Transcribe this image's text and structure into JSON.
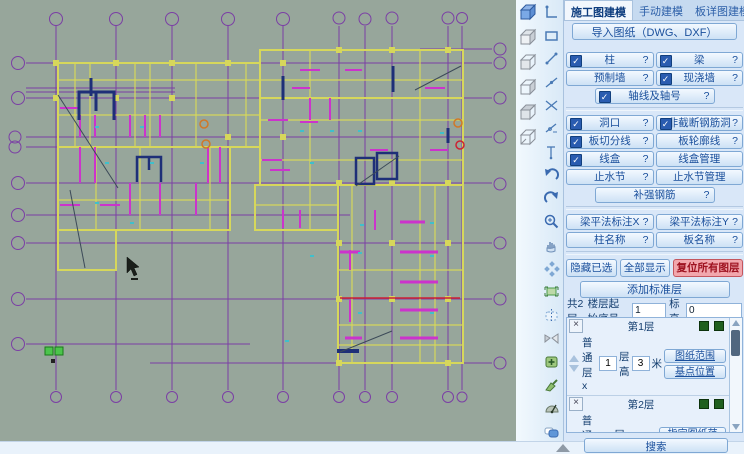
{
  "header": {
    "tab1": "施工图建模",
    "tab2": "手动建模",
    "tab3": "板详图建模",
    "import_label": "导入图纸（DWG、DXF）"
  },
  "glyphs": {
    "check": "✓",
    "help": "?",
    "close": "×"
  },
  "panel": {
    "toggles": {
      "zhu": {
        "label": "柱"
      },
      "liang": {
        "label": "梁"
      },
      "yzq": {
        "label": "预制墙"
      },
      "xjq": {
        "label": "现浇墙"
      },
      "zhou": {
        "label": "轴线及轴号"
      },
      "dong": {
        "label": "洞口"
      },
      "fjd": {
        "label": "非截断钢筋洞"
      },
      "bqfx": {
        "label": "板切分线"
      },
      "blkx": {
        "label": "板轮廓线"
      },
      "xh": {
        "label": "线盒"
      },
      "xhgl": {
        "label": "线盒管理"
      },
      "zsj": {
        "label": "止水节"
      },
      "zsjgl": {
        "label": "止水节管理"
      },
      "bqgj": {
        "label": "补强钢筋"
      },
      "lpfx": {
        "label": "梁平法标注X"
      },
      "lpfy": {
        "label": "梁平法标注Y"
      },
      "zmc": {
        "label": "柱名称"
      },
      "bmc": {
        "label": "板名称"
      }
    },
    "actions": {
      "hide_selected": "隐藏已选",
      "show_all": "全部显示",
      "reset_layers": "复位所有图层"
    },
    "add_standard_layer": "添加标准层",
    "summary": {
      "total": "共2层",
      "start_label": "楼层起始序号",
      "start_value": "1",
      "elev_label": "标高",
      "elev_value": "0"
    },
    "layers": {
      "items": [
        {
          "name": "第1层",
          "type_prefix": "普通层x",
          "count": "1",
          "height_label": "层高",
          "height": "3",
          "unit": "米",
          "btn1": "图纸范围",
          "btn2": "基点位置"
        },
        {
          "name": "第2层",
          "type_prefix": "普通层x",
          "count": "1",
          "height_label": "层高",
          "height": "3",
          "unit": "米",
          "btn1": "指定图纸范围",
          "btn2": "指定基点位置"
        }
      ]
    },
    "search_label": "搜索"
  },
  "colors": {
    "canvas_bg": "#97a69b",
    "axis_purple": "#7b3fa5",
    "beam_yellow": "#d6d75b",
    "slab_magenta": "#cc33cc",
    "stair_navy": "#1e2f78",
    "alert_red": "#cc2233",
    "accent_orange": "#d07828",
    "mark_cyan": "#3fc0cc",
    "origin_green": "#4cc44c",
    "panel_blue": "#d9e7f8",
    "button_text_blue": "#1a4f9c",
    "reset_button_pink": "#f2a7ad"
  }
}
